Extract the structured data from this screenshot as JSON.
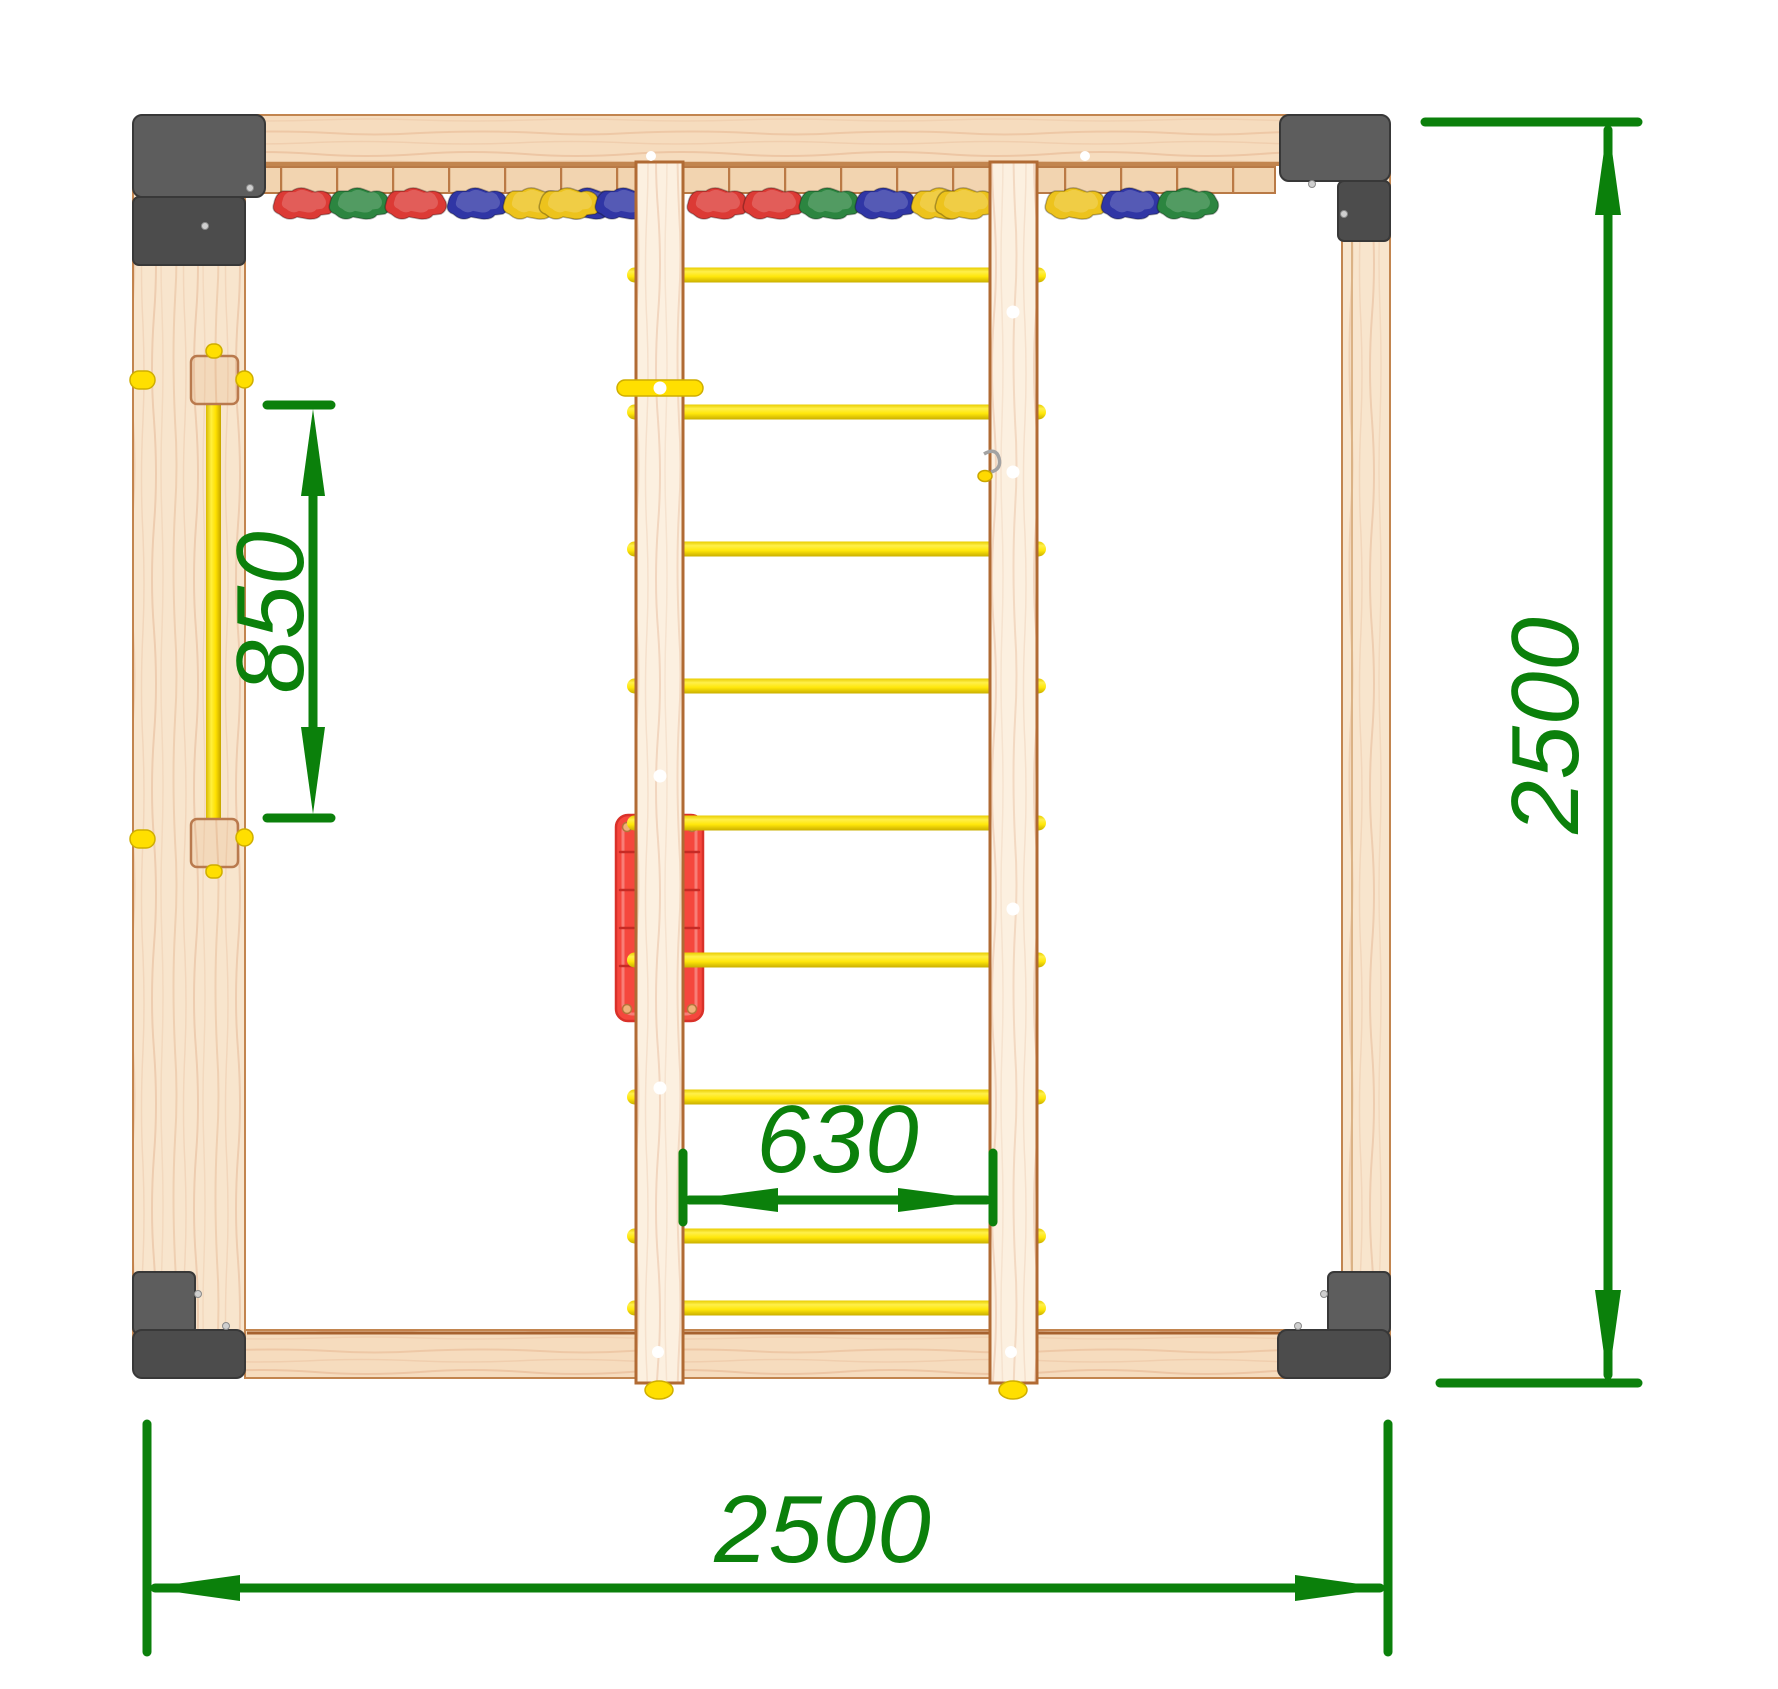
{
  "drawing": {
    "type": "technical-dimension-drawing",
    "subject": "top view of a wooden kids climbing / sport corner structure with ladder, wall bar and climbing holds",
    "background": "#ffffff",
    "annotation_color": "#0b800b",
    "dimensions": {
      "bar_length": {
        "value": "850"
      },
      "rung_span": {
        "value": "630"
      },
      "overall_width": {
        "value": "2500"
      },
      "overall_depth": {
        "value": "2500"
      }
    },
    "palette": {
      "wood_beam": "#f6dcbe",
      "wood_post": "#f8e5cd",
      "wood_stringer": "#fcf0e0",
      "wood_edge": "#bd7c49",
      "bracket_gray": "#4c4c4c",
      "bracket_gray_light": "#5d5d5d",
      "rung_yellow": "#ffe70a",
      "panel_red": "#f5473d",
      "hold_colors": {
        "red": "#dc3a35",
        "green": "#2c8540",
        "blue": "#3036a5",
        "yellow": "#edc31d"
      }
    },
    "ladder": {
      "rung_count": 9,
      "rung_ys": [
        275,
        412,
        549,
        686,
        823,
        960,
        1097,
        1236,
        1308
      ]
    },
    "hold_groups": [
      {
        "x": 272,
        "colors": [
          "red",
          "green",
          "red"
        ]
      },
      {
        "x": 446,
        "colors": [
          "blue",
          "yellow",
          "blue"
        ]
      },
      {
        "x": 538,
        "colors": [
          "yellow",
          "blue"
        ]
      },
      {
        "x": 686,
        "colors": [
          "red",
          "red",
          "green",
          "blue",
          "yellow"
        ]
      },
      {
        "x": 934,
        "colors": [
          "yellow"
        ]
      },
      {
        "x": 1044,
        "colors": [
          "yellow",
          "blue",
          "green"
        ]
      }
    ]
  }
}
